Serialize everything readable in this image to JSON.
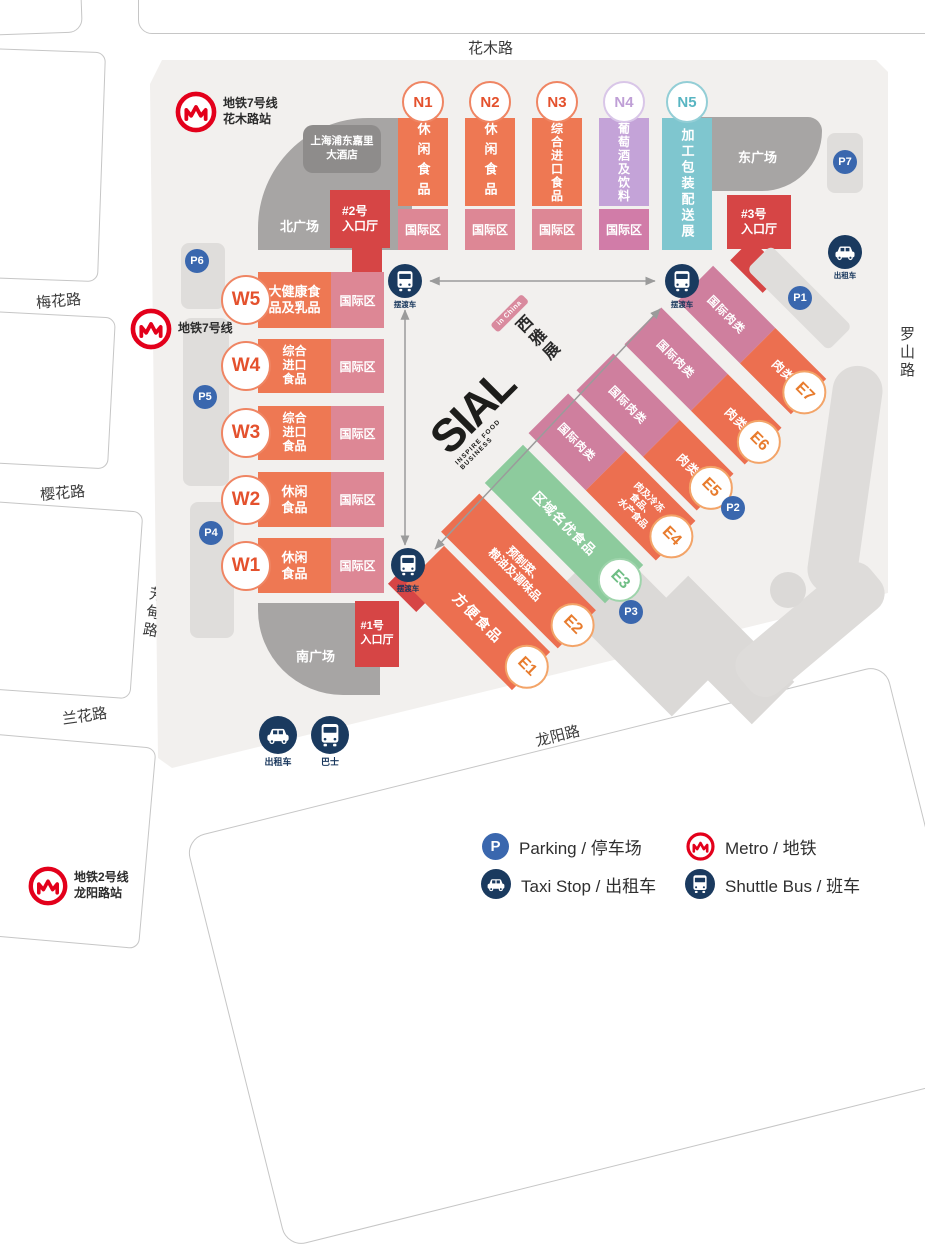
{
  "roads": {
    "huamu": "花木路",
    "meihua": "梅花路",
    "yinghua": "樱花路",
    "fangdian": "芳甸路",
    "lanhua": "兰花路",
    "longyang": "龙阳路",
    "luoshan": "罗山路"
  },
  "metro": {
    "line7_huamu": {
      "line": "地铁7号线",
      "station": "花木路站"
    },
    "line7": {
      "line": "地铁7号线"
    },
    "line2_longyang": {
      "line": "地铁2号线",
      "station": "龙阳路站"
    }
  },
  "hotel": {
    "name": "上海浦东嘉里\n大酒店"
  },
  "plazas": {
    "north": "北广场",
    "east": "东广场",
    "south": "南广场"
  },
  "entrances": {
    "e1": "#1号\n入口厅",
    "e2": "#2号\n入口厅",
    "e3": "#3号\n入口厅"
  },
  "halls_n": [
    {
      "id": "N1",
      "category": "休闲食品",
      "zone": "国际区"
    },
    {
      "id": "N2",
      "category": "休闲食品",
      "zone": "国际区"
    },
    {
      "id": "N3",
      "category": "综合进口食品",
      "zone": "国际区"
    },
    {
      "id": "N4",
      "category": "葡萄酒及饮料",
      "zone": "国际区"
    },
    {
      "id": "N5",
      "category": "加工包装配送展"
    }
  ],
  "halls_w": [
    {
      "id": "W5",
      "category": "大健康食\n品及乳品",
      "zone": "国际区"
    },
    {
      "id": "W4",
      "category": "综合\n进口\n食品",
      "zone": "国际区"
    },
    {
      "id": "W3",
      "category": "综合\n进口\n食品",
      "zone": "国际区"
    },
    {
      "id": "W2",
      "category": "休闲\n食品",
      "zone": "国际区"
    },
    {
      "id": "W1",
      "category": "休闲\n食品",
      "zone": "国际区"
    }
  ],
  "halls_e": [
    {
      "id": "E1",
      "category": "方便食品"
    },
    {
      "id": "E2",
      "category": "预制菜、\n粮油及调味品"
    },
    {
      "id": "E3",
      "category": "区域名优食品"
    },
    {
      "id": "E4",
      "intl": "国际肉类",
      "category": "肉及冷冻\n食品、\n水产食品"
    },
    {
      "id": "E5",
      "intl": "国际肉类",
      "category": "肉类"
    },
    {
      "id": "E6",
      "intl": "国际肉类",
      "category": "肉类"
    },
    {
      "id": "E7",
      "intl": "国际肉类",
      "category": "肉类"
    }
  ],
  "parking": {
    "p1": "P1",
    "p2": "P2",
    "p3": "P3",
    "p4": "P4",
    "p5": "P5",
    "p6": "P6",
    "p7": "P7"
  },
  "transport": {
    "shuttle": "摆渡车",
    "taxi": "出租车",
    "bus": "巴士"
  },
  "logo": {
    "name": "SIAL",
    "tagline": "INSPIRE FOOD BUSINESS",
    "cn": "西雅展",
    "badge": "in China"
  },
  "legend": {
    "parking": "Parking / 停车场",
    "metro": "Metro / 地铁",
    "taxi": "Taxi Stop / 出租车",
    "shuttle": "Shuttle Bus / 班车"
  },
  "colors": {
    "hall_orange": "#ee7853",
    "intl_zone_pink": "#dd8795",
    "intl_meat_pink": "#cf7f9e",
    "wine_purple": "#c4a3d8",
    "processing_teal": "#7fc6cf",
    "regional_green": "#8dcb9d",
    "entrance_red": "#d64545",
    "plaza_gray": "#a7a5a4",
    "parking_blue": "#3a67ae",
    "transport_navy": "#1a3a5f",
    "metro_red": "#e3001b"
  }
}
